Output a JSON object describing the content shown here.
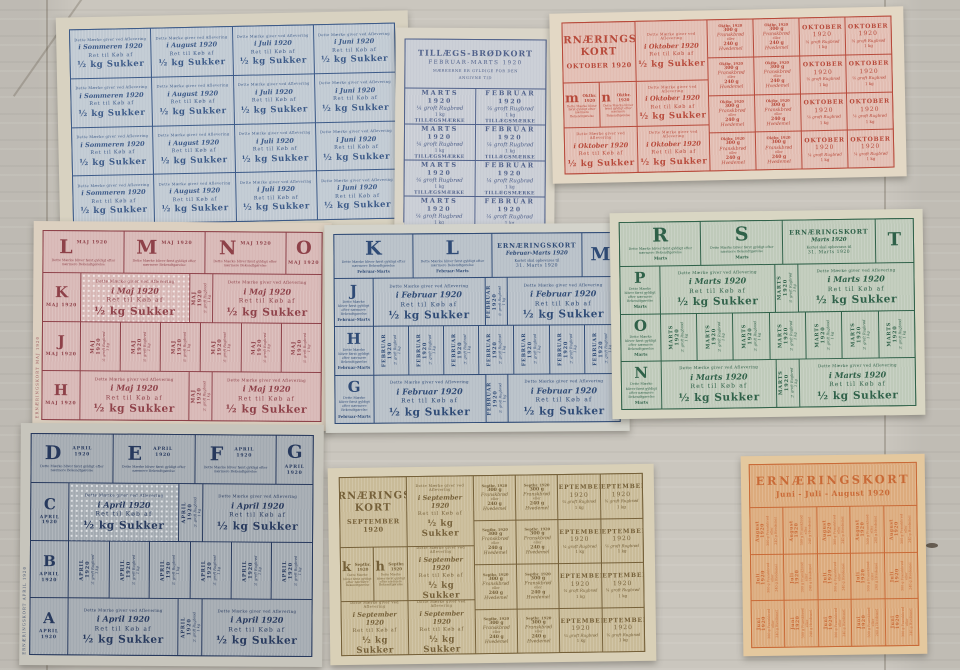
{
  "scene_colors": {
    "wood": "#cac6be",
    "wood_seam": "rgba(90,78,66,0.28)",
    "knot": "#4f4438",
    "scratch": "rgba(146,96,58,0.5)"
  },
  "shared": {
    "dette_afl": "Dette Mærke giver ved Aflevering",
    "ret": "Ret til Køb af",
    "sukker": "½ kg Sukker",
    "gyldig": "Dette Mærke bliver først gyldigt efter nærmere Bekendtgørelse",
    "rugbrod": "¼ groft Rugbrød",
    "one_kg": "1 kg",
    "fransk": {
      "g300": "300 g",
      "name": "Franskbrød",
      "eller": "eller",
      "g240": "240 g",
      "hvedemel": "Hvedemel"
    }
  },
  "cards": {
    "c1": {
      "type": "sugar_grid",
      "rows": 4,
      "columns": [
        "i Sommeren 1920",
        "i August 1920",
        "i Juli 1920",
        "i Juni 1920"
      ],
      "colors": {
        "ink": "#3c5a88",
        "paper": "#c0c9d2",
        "edge": "#d8d2c1"
      }
    },
    "c2": {
      "type": "brodkort",
      "title": "TILLÆGS-BRØDKORT",
      "subtitle": "FEBRUAR-MARTS 1920",
      "note1": "MÆRKERNE ER GYLDIGE FOR DEN",
      "note2": "ANGIVNE TID",
      "rows": 4,
      "columns": [
        "MARTS",
        "FEBRUAR"
      ],
      "year": "1920",
      "stamp": "TILLÆGSMÆRKE",
      "colors": {
        "ink": "#51628b",
        "paper": "#c8ccd4",
        "edge": "#dad5c8"
      }
    },
    "c3": {
      "type": "wide",
      "title1": "ERNÆRINGS-",
      "title2": "KORT",
      "month_title": "OKTOBER 1920",
      "letters": [
        {
          "ch": "m",
          "date": "Oktbr. 1920"
        },
        {
          "ch": "n",
          "date": "Oktbr. 1920"
        }
      ],
      "sugar_month": "i Oktober 1920",
      "small_date": "Oktbr. 1920",
      "bread_month": "OKTOBER",
      "bread_year": "1920",
      "colors": {
        "ink": "#b7493a",
        "paper": "#e2bdb2",
        "edge": "#e3d8c5"
      }
    },
    "c4": {
      "type": "letters",
      "top_letters": [
        "L",
        "M",
        "N"
      ],
      "corner_letter": "O",
      "left_letters": [
        "K",
        "J",
        "H"
      ],
      "date_label": "MAJ 1920",
      "sugar_month": "i Maj 1920",
      "bread_month": "MAJ 1920",
      "mid_cells": 6,
      "strip": "ERNÆRINGSKORT MAJ 1920",
      "colors": {
        "ink": "#8e4149",
        "paper": "#d7b7b5",
        "edge": "#dcd0c0"
      }
    },
    "c5": {
      "type": "letters_header",
      "top_letters": [
        "K",
        "L"
      ],
      "corner_letter": "M",
      "left_letters": [
        "J",
        "H",
        "G"
      ],
      "header_title": "ERNÆRINGSKORT",
      "header_subtitle": "Februar-Marts 1920",
      "header_note": "Kortet skal opbevares til",
      "header_date": "31. Marts 1920",
      "letter_sublabel": "Februar-Marts",
      "sugar_month": "i Februar 1920",
      "bread_month": "FEBRUAR 1920",
      "mid_cells": 7,
      "colors": {
        "ink": "#2f4b76",
        "paper": "#b7bfc7",
        "edge": "#d3d3cb"
      }
    },
    "c6": {
      "type": "letters_header",
      "top_letters": [
        "R",
        "S"
      ],
      "corner_letter": "T",
      "left_letters": [
        "P",
        "O",
        "N"
      ],
      "header_title": "ERNÆRINGSKORT",
      "header_subtitle": "Marts 1920",
      "header_note": "Kortet skal opbevares til",
      "header_date": "31. Marts 1920",
      "letter_sublabel": "Marts",
      "sugar_month": "i Marts 1920",
      "bread_month": "MARTS 1920",
      "mid_cells": 7,
      "colors": {
        "ink": "#2f6149",
        "paper": "#bfcaba",
        "edge": "#d9d6c3"
      }
    },
    "c7": {
      "type": "letters",
      "top_letters": [
        "D",
        "E",
        "F"
      ],
      "corner_letter": "G",
      "left_letters": [
        "C",
        "B",
        "A"
      ],
      "date_label": "APRIL 1920",
      "sugar_month": "i April 1920",
      "bread_month": "APRIL 1920",
      "mid_cells": 6,
      "strip": "ERNÆRINGSKORT APRIL 1920",
      "colors": {
        "ink": "#27395d",
        "paper": "#a3aab1",
        "edge": "#c7c5bc"
      }
    },
    "c8": {
      "type": "wide",
      "title1": "ERNÆRINGS-",
      "title2": "KORT",
      "month_title": "SEPTEMBER 1920",
      "letters": [
        {
          "ch": "k",
          "date": "Septbr. 1920"
        },
        {
          "ch": "h",
          "date": "Septbr. 1920"
        }
      ],
      "sugar_month": "i September 1920",
      "small_date": "Septbr. 1920",
      "bread_month": "SEPTEMBER",
      "bread_year": "1920",
      "colors": {
        "ink": "#756039",
        "paper": "#c9bb98",
        "edge": "#d9d0b7"
      }
    },
    "c9": {
      "type": "orange",
      "title": "ERNÆRINGSKORT",
      "subtitle": "Juni - Juli - August 1920",
      "row_months": [
        "August 1920",
        "Juli 1920",
        "Juni 1920"
      ],
      "cols": 5,
      "cell_lines": [
        "300 g Franskbrød",
        "eller",
        "240 g Hvedemel"
      ],
      "colors": {
        "ink": "#c96a37",
        "paper": "#dcab7d",
        "edge": "#e4c89e"
      }
    }
  }
}
